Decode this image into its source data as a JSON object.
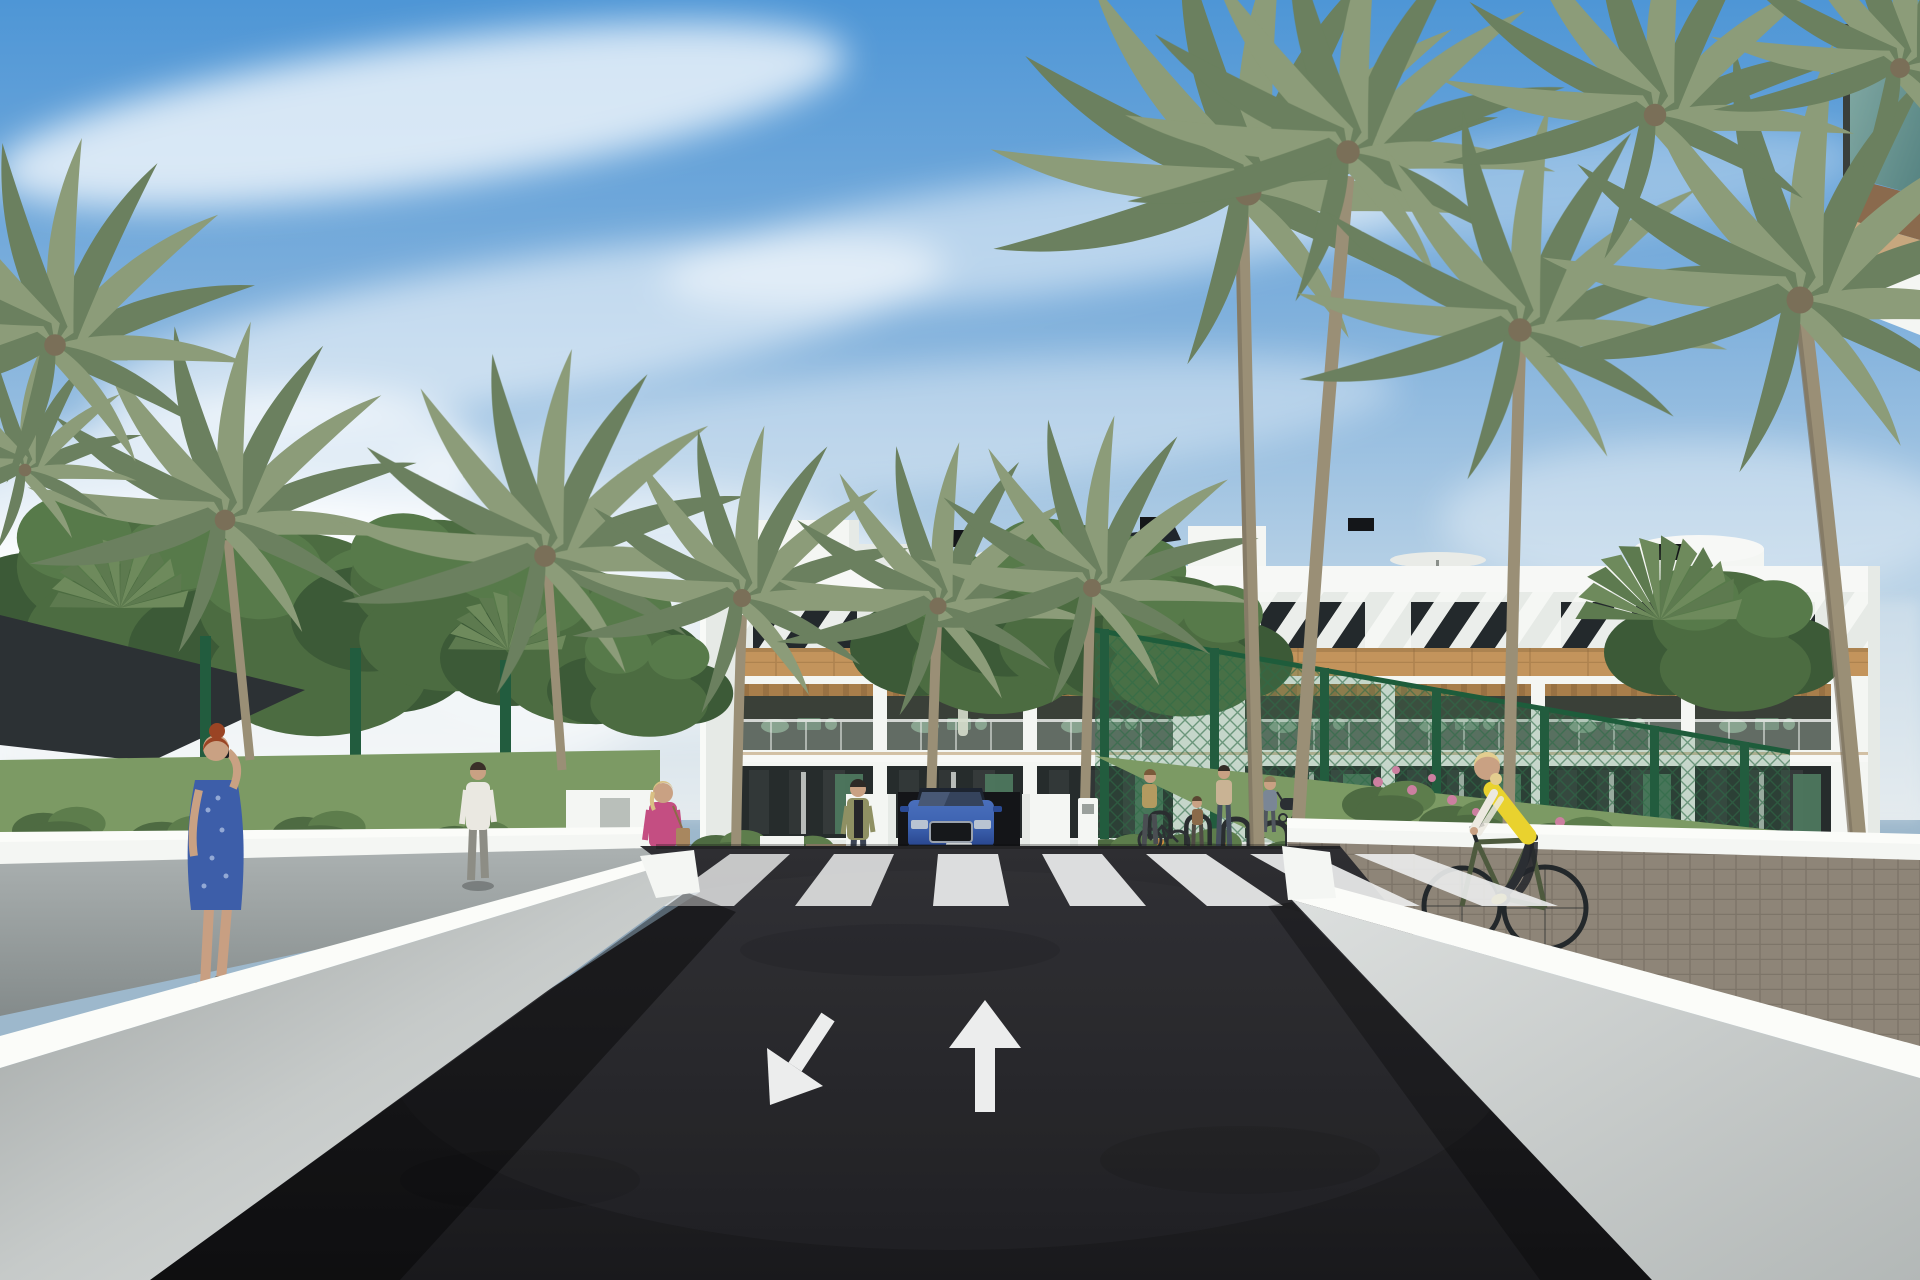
{
  "scene": {
    "type": "architectural-3d-render",
    "description": "Sunny 3D visualization of a white three-storey apartment complex with wood-clad accents, palm trees, a dark asphalt street with zebra crosswalk and lane arrows, white retaining walls, a blue SUV at a garage ramp, pedestrians and a cyclist.",
    "elements": [
      "blue sky with wispy clouds",
      "white apartment building with diagonal brise-soleil attic",
      "wood band and pergola balconies",
      "roof stair bulkheads",
      "rounded roof water tank",
      "roof parasols",
      "black roof vents",
      "palm trees",
      "fan palms",
      "deciduous trees",
      "dark shade sail",
      "green sports-court fence",
      "flowering shrubs",
      "asphalt road",
      "zebra crosswalk",
      "lane arrows",
      "white retaining walls",
      "grey sidewalk",
      "brick paver path",
      "blue SUV",
      "garage ramp",
      "bike racks",
      "pedestrians",
      "cyclist",
      "stroller"
    ]
  },
  "building": {
    "floors": 3,
    "facade": "white render with diagonal white brise-soleil slats on attic level",
    "accents": "timber-clad band with timber pergolas over balconies",
    "roof_features": [
      "stair bulkheads",
      "water tank",
      "parasols",
      "black vents",
      "solar panel"
    ],
    "balcony_bays_left": 3,
    "balcony_bays_right": 4
  },
  "road": {
    "surface": "dark asphalt",
    "crosswalk_stripe_count": 7,
    "lane_arrow_left": "down-left (oncoming lane)",
    "lane_arrow_right": "straight up (forward lane)",
    "ramp_arrows": [
      "down",
      "up"
    ]
  },
  "vehicle": {
    "type": "SUV",
    "color_name": "blue",
    "hex": "#3c62b0",
    "position": "emerging from garage ramp at building center"
  },
  "people": [
    {
      "id": "woman-blue-dress",
      "description": "red-haired woman in blue patterned dress walking on left sidewalk holding phone to ear"
    },
    {
      "id": "man-white-tee",
      "description": "man in white t-shirt and grey trousers walking toward garden gate"
    },
    {
      "id": "woman-pink-jacket",
      "description": "blonde woman in pink jacket with tan handbag near crosswalk"
    },
    {
      "id": "woman-olive-cardigan",
      "description": "dark-haired woman in olive cardigan standing on entry path"
    },
    {
      "id": "woman-with-bicycle",
      "description": "woman pushing a bicycle near bike racks"
    },
    {
      "id": "child",
      "description": "small child beside woman at bike racks"
    },
    {
      "id": "woman-floral-top",
      "description": "woman in floral top at bike racks"
    },
    {
      "id": "person-with-stroller",
      "description": "person pushing a stroller on right path"
    },
    {
      "id": "cyclist-yellow-vest",
      "description": "blonde cyclist in yellow vest and white sleeves riding dark green bicycle on right paver path"
    },
    {
      "id": "balcony-resident",
      "description": "tiny figure standing on first-floor balcony"
    }
  ],
  "street_furniture": {
    "bike_racks": 6,
    "sign_totem": "small white monolith sign at garage ramp"
  },
  "colors": {
    "sky_top": "#4e96d6",
    "sky_mid": "#8ab7de",
    "sky_horizon": "#e3eaee",
    "cloud": "#ffffff",
    "building_white": "#f4f6f3",
    "parapet": "#f7f8f6",
    "building_shade": "#e6eae6",
    "window_dark": "#23292c",
    "attic_slat": "#f6f8f5",
    "wood_band": "#c3945c",
    "pergola_wood": "#a87e4b",
    "balcony_interior": "#3a4038",
    "furniture_green": "#74927a",
    "ground_floor": "#262c2c",
    "door_green": "#4e7a60",
    "glass_balustrade": "#b9c9c2",
    "near_balcony_glass": "#6f9b8f",
    "near_fascia": "#8a6a4d",
    "near_soffit": "#c7a77e",
    "asphalt": "#26262a",
    "asphalt_deep": "#19191c",
    "road_marking": "#eceded",
    "wall_top": "#fbfcf9",
    "wall_face": "#d3d7d6",
    "wall_face_shade": "#9ba09f",
    "sidewalk": "#9aa0a0",
    "paver": "#8e8578",
    "paver_line": "#6e675c",
    "grass": "#7c9a64",
    "hedge_dark": "#4e6b42",
    "hedge_mid": "#5d7d4c",
    "tree_dark": "#3c5a37",
    "tree_mid": "#4c6c41",
    "tree_light": "#577a4a",
    "palm_dark": "#6b805f",
    "palm_light": "#8c9c79",
    "fan_palm": "#5d7a4f",
    "fan_palm_light": "#6e8a5c",
    "trunk": "#9a8f76",
    "trunk_shade": "#7c7260",
    "fence_green": "#225c3e",
    "fence_mesh": "#3f7a55",
    "shade_sail": "#2c3134",
    "car_blue": "#3c62b0",
    "car_blue_dark": "#2a4a94",
    "car_glass": "#1d2430",
    "skin": "#c9a183",
    "flower_pink": "#cc7fa0",
    "flower_orange": "#d9923e",
    "dress_blue": "#3d5ea9",
    "hair_red": "#9a4424",
    "jacket_pink": "#c44e82",
    "hair_blonde": "#d9c084",
    "tee_white": "#eae8e1",
    "cardigan_olive": "#8f9063",
    "vest_yellow": "#e9d22e",
    "bike_dark": "#23282b"
  }
}
